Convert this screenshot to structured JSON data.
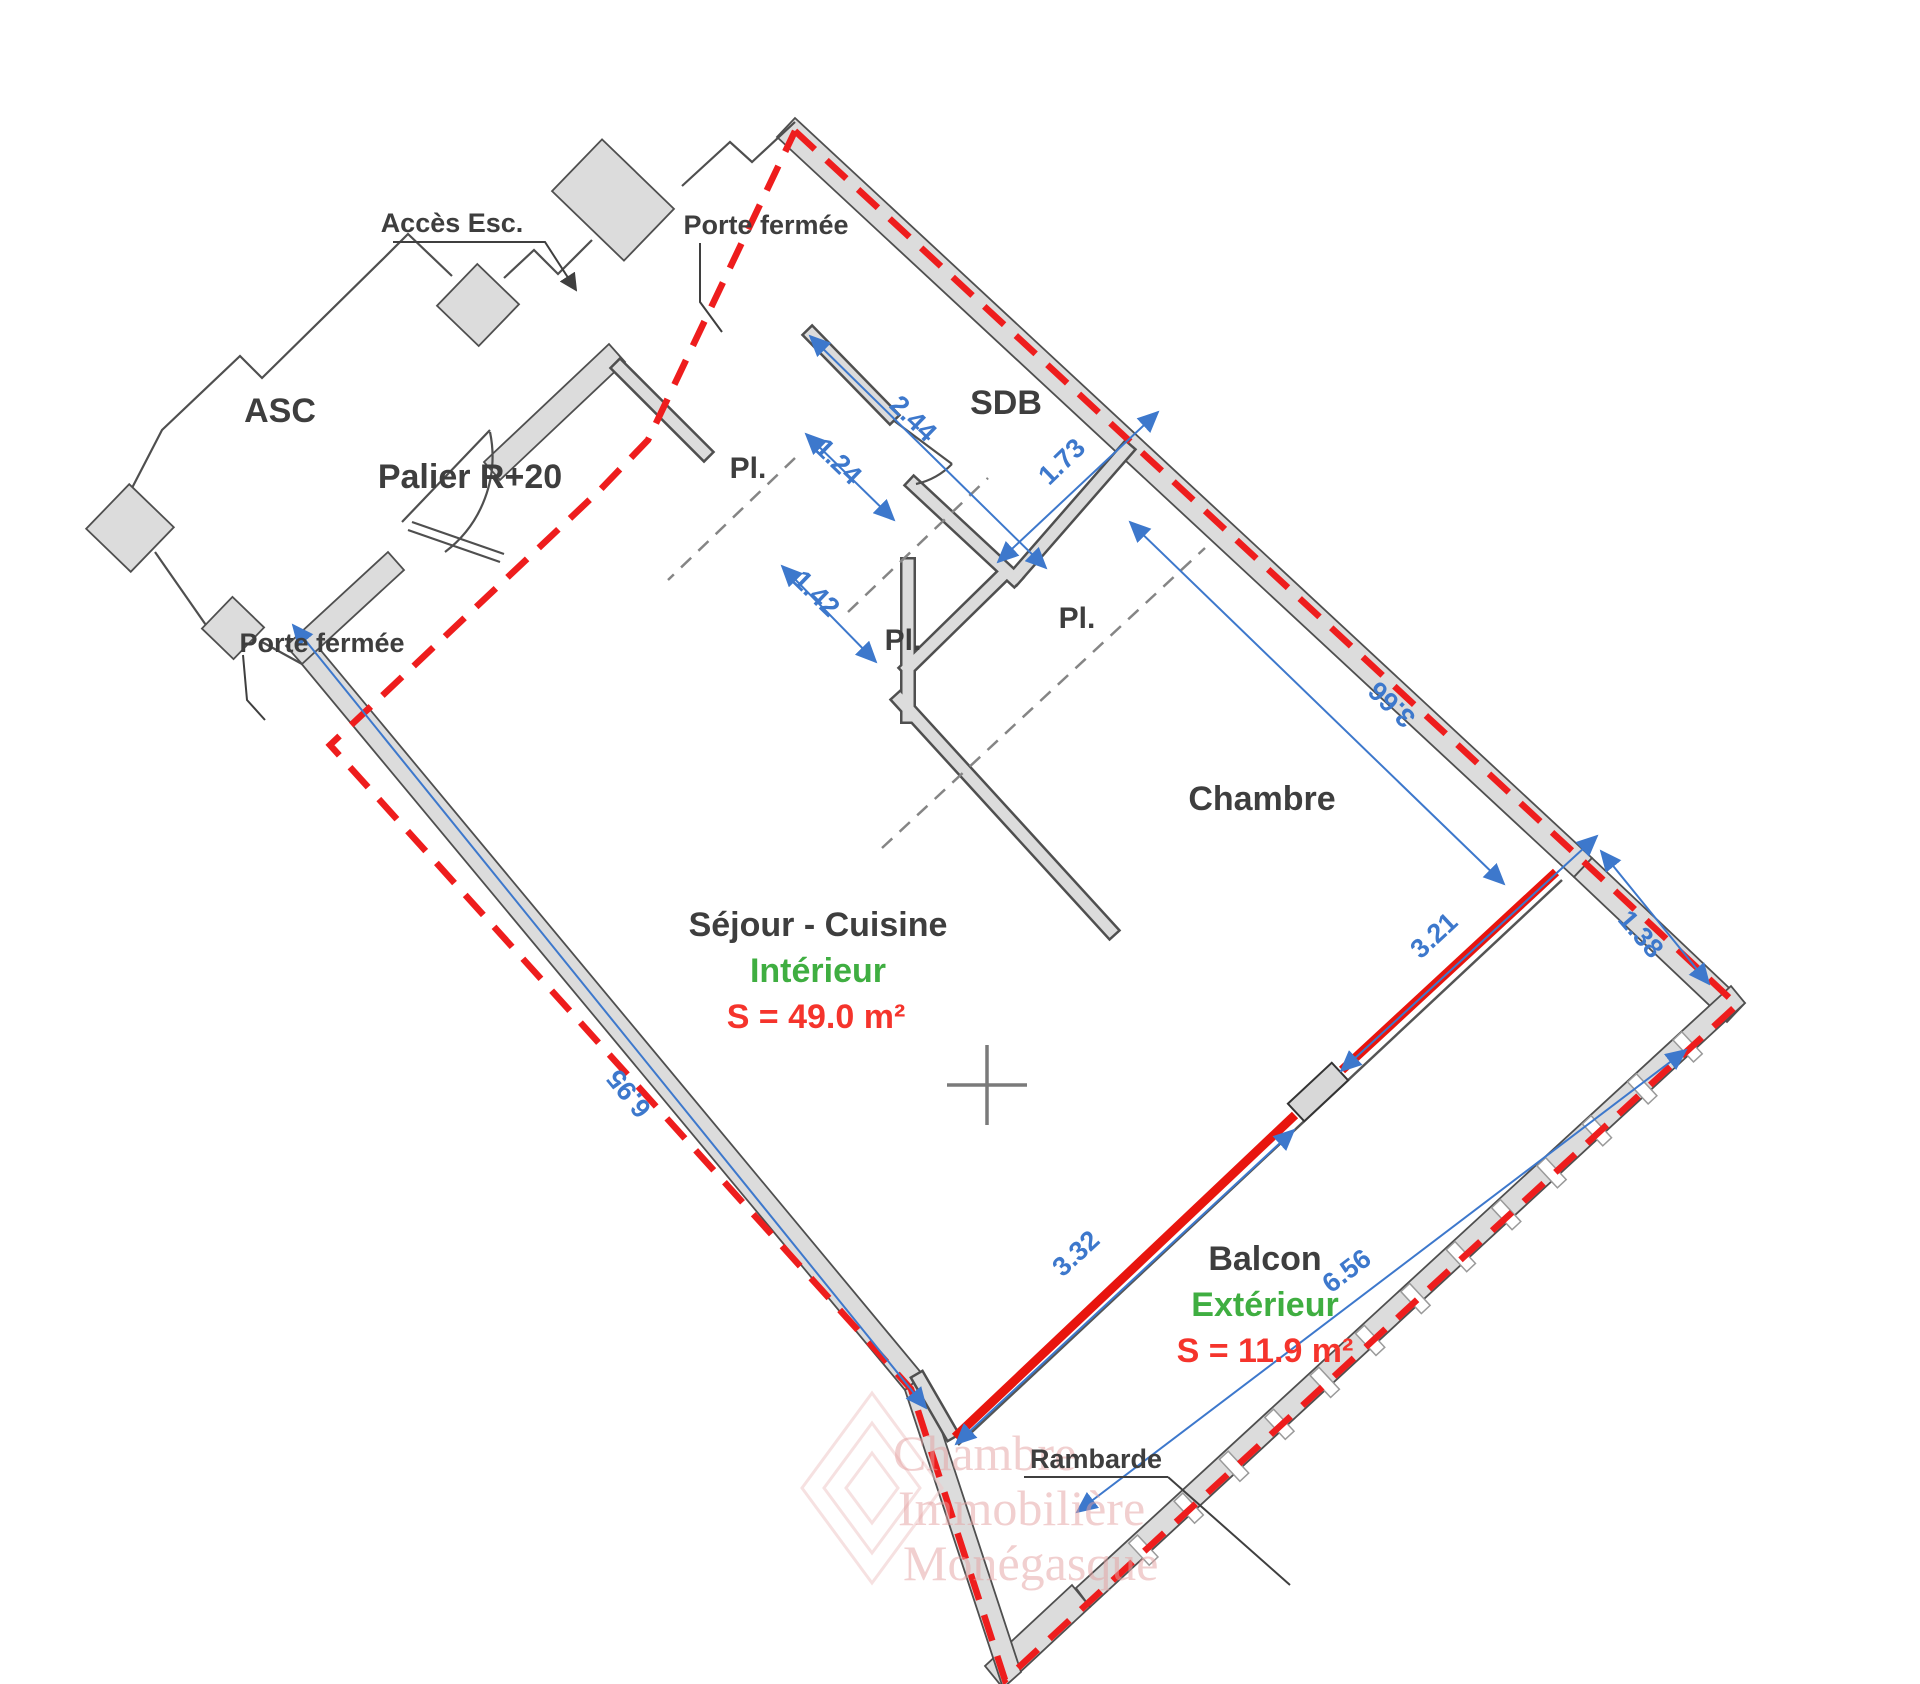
{
  "plan": {
    "landing": {
      "elevator_label": "ASC",
      "landing_label": "Palier R+20",
      "stairs_access_label": "Accès Esc.",
      "closed_door_top_label": "Porte fermée",
      "closed_door_left_label": "Porte fermée"
    },
    "rooms": {
      "bathroom": "SDB",
      "closet_entry": "Pl.",
      "closet_middle": "Pl.",
      "closet_bedroom": "Pl.",
      "bedroom": "Chambre",
      "living_kitchen": "Séjour - Cuisine",
      "balcony": "Balcon"
    },
    "areas": {
      "interior_zone": "Intérieur",
      "interior_area": "S = 49.0 m²",
      "exterior_zone": "Extérieur",
      "exterior_area": "S = 11.9 m²"
    },
    "dimensions": {
      "sdb_side": "2.44",
      "closet_width": "1.24",
      "hall_width": "1.42",
      "sdb_width": "1.73",
      "bedroom_width": "3.66",
      "living_length": "6.95",
      "glazing_lower": "3.32",
      "glazing_upper": "3.21",
      "balcony_end": "1.38",
      "balcony_length": "6.56"
    },
    "railing_label": "Rambarde",
    "watermark_lines": [
      "Chambre",
      "Immobilière",
      "Monégasque"
    ],
    "colors": {
      "dimension_blue": "#3d78cc",
      "boundary_red": "#ee1d1d",
      "glazing_red": "#e8150e",
      "area_red": "#f5342c",
      "zone_green": "#3fae41",
      "wall_gray": "#dcdcdc",
      "wall_edge": "#4f4f4f",
      "text_dark": "#3e3e3e"
    }
  }
}
